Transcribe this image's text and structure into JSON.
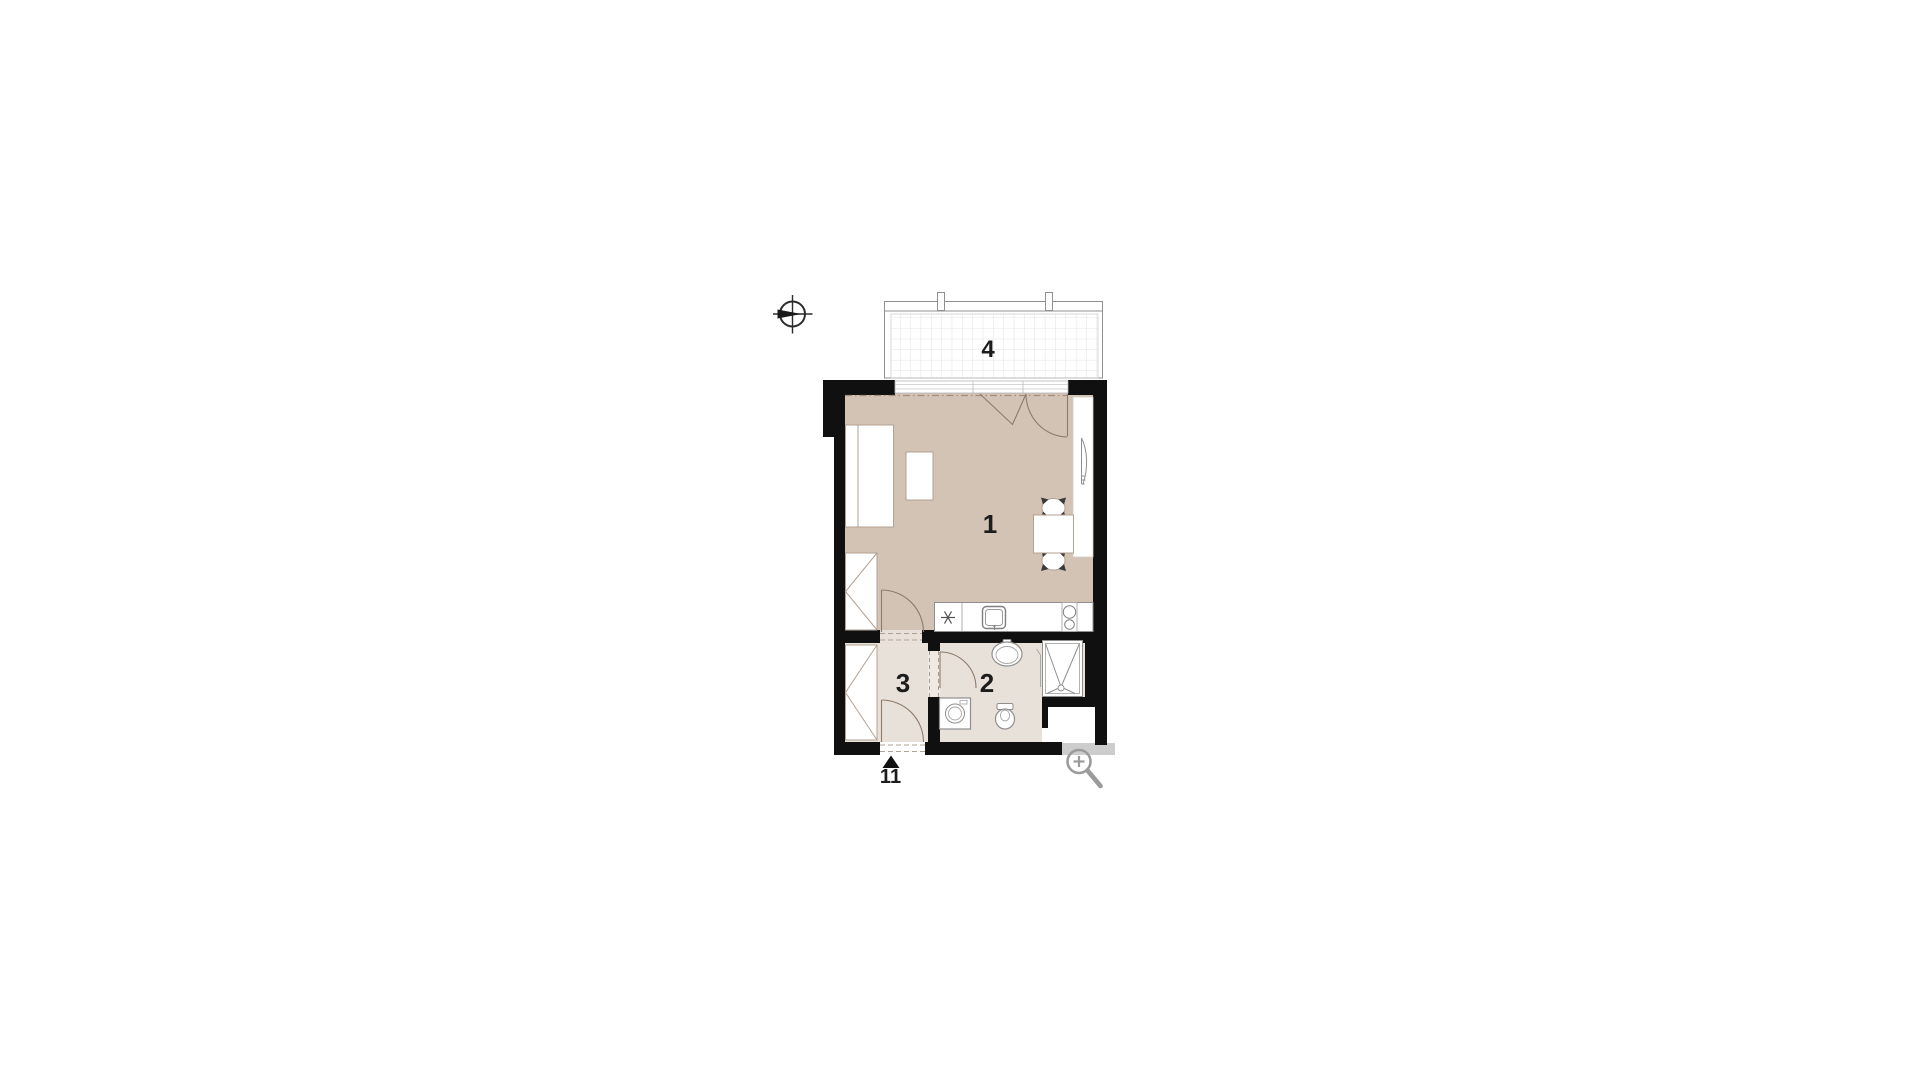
{
  "plan": {
    "labels": {
      "room1": "1",
      "room2": "2",
      "room3": "3",
      "balcony": "4",
      "entrance_unit": "11"
    }
  },
  "icons": {
    "compass": "compass-crosshair-circle",
    "magnifier": "magnifying-glass-plus",
    "entrance_arrow": "filled-triangle-up"
  },
  "colors": {
    "wall": "#101010",
    "room_fill": "#d3c3b5",
    "wet_room_fill": "#e8e1d9",
    "furniture_stroke": "#b3a293",
    "fixture_stroke": "#8f8f8f",
    "door_arc": "#8d7b6c",
    "balcony_grid": "#dcdcdc",
    "label_text": "#1c1c1c",
    "magnifier_gray": "#9b9b9b",
    "shadow_band": "#cdcdcd",
    "background": "#ffffff"
  }
}
